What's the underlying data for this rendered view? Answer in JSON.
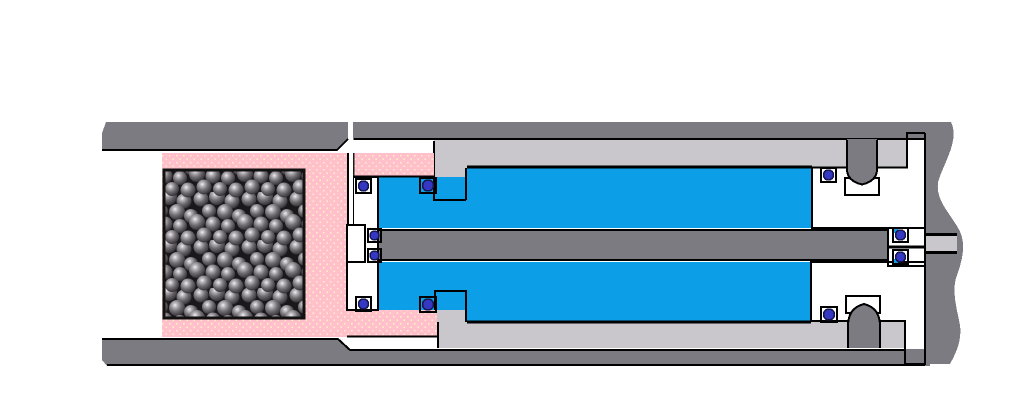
{
  "diagram": {
    "kind": "mechanical cross-section schematic",
    "parts": {
      "outer_tube": "outer housing tube (split, left end bevelled)",
      "shot_piston": "pink piston shell filled with shot balls",
      "shot_fill": "packed spherical shot media",
      "cylinder": "inner cylinder body with entrance bosses",
      "fluid": "fluid chambers above and below piston rod",
      "rod": "central piston rod with end gland",
      "float_piston": "yellow floating piston / end gland pair",
      "end_plug": "right end plug with break-line edge",
      "o_rings": "ten o-ring seals in white grooves",
      "set_screws": "two retaining screws with relief notches"
    }
  },
  "colors": {
    "background": "#ffffff",
    "outer_tube": "#7d7b82",
    "cylinder_body": "#c9c7cc",
    "fluid": "#0c9fe8",
    "float_piston": "#fdc40b",
    "shot_piston": "#ffc0cb",
    "shot_piston_dots": "#fff3c4",
    "shot_fill_bg": "#1b181c",
    "ball_hi": "#f0eff1",
    "ball_mid": "#b5b2b7",
    "ball_body": "#716d72",
    "ball_edge": "#242126",
    "oring": "#3538c2",
    "oring_rim": "#15174e",
    "outline": "#000000",
    "white": "#ffffff"
  }
}
